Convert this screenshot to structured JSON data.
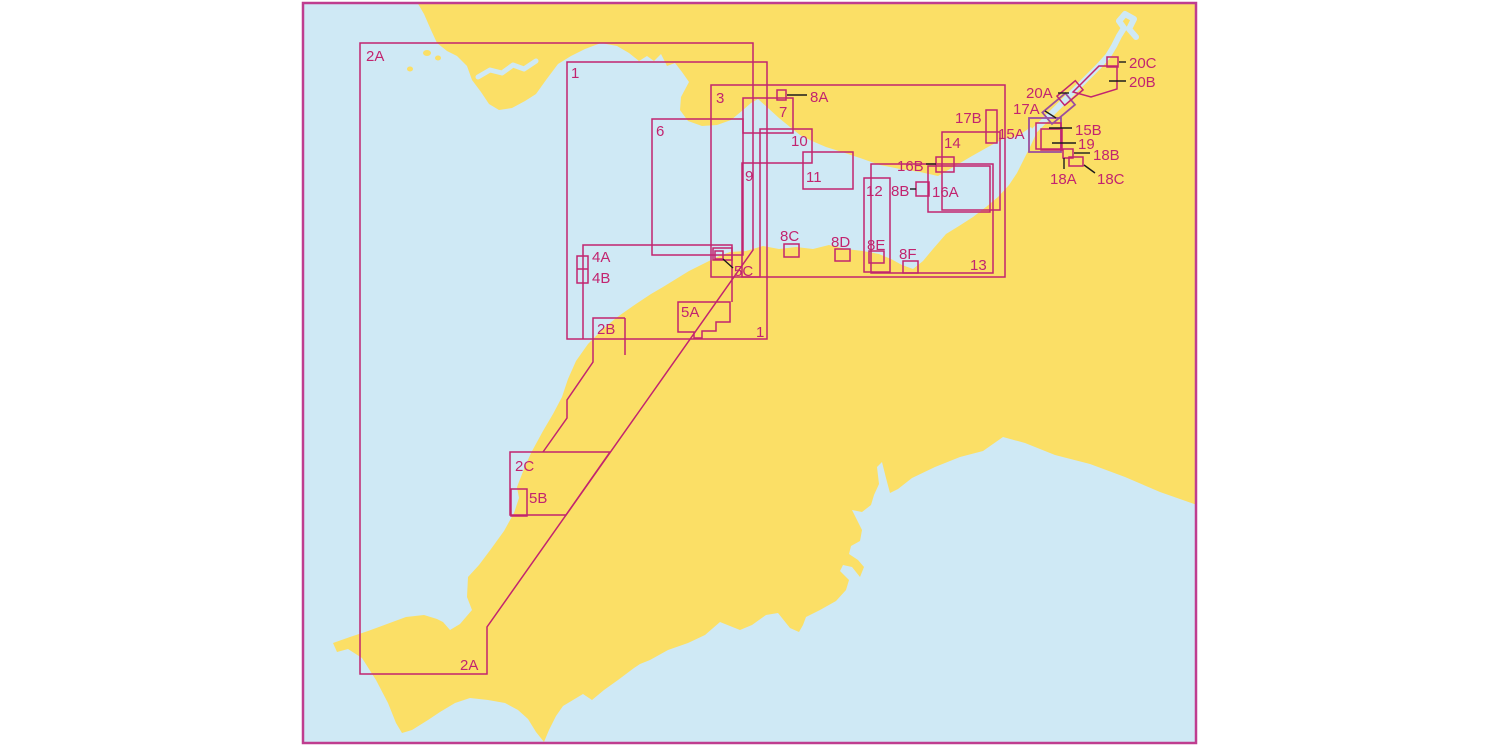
{
  "colors": {
    "background": "#ffffff",
    "sea": "#cfe9f5",
    "land": "#fbdf66",
    "outline": "#c2246f",
    "outline_alt": "#9b4f9e",
    "frame": "#bf3d8f",
    "leader": "#1c1c1c",
    "label_text": "#c2246f"
  },
  "labels": {
    "chart_2a_nw": "2A",
    "chart_1_nw": "1",
    "chart_3": "3",
    "chart_8a": "8A",
    "chart_7": "7",
    "chart_6": "6",
    "chart_10": "10",
    "chart_9": "9",
    "chart_11": "11",
    "chart_12": "12",
    "chart_8b": "8B",
    "chart_16a": "16A",
    "chart_16b": "16B",
    "chart_14": "14",
    "chart_17b": "17B",
    "chart_15a": "15A",
    "chart_17a": "17A",
    "chart_20a": "20A",
    "chart_20b": "20B",
    "chart_20c": "20C",
    "chart_15b": "15B",
    "chart_19": "19",
    "chart_18a": "18A",
    "chart_18b": "18B",
    "chart_18c": "18C",
    "chart_8c": "8C",
    "chart_8d": "8D",
    "chart_8e": "8E",
    "chart_8f": "8F",
    "chart_13": "13",
    "chart_5c": "5C",
    "chart_4a": "4A",
    "chart_4b": "4B",
    "chart_2b": "2B",
    "chart_1_se": "1",
    "chart_5a": "5A",
    "chart_2c": "2C",
    "chart_5b": "5B",
    "chart_2a_sw": "2A"
  }
}
